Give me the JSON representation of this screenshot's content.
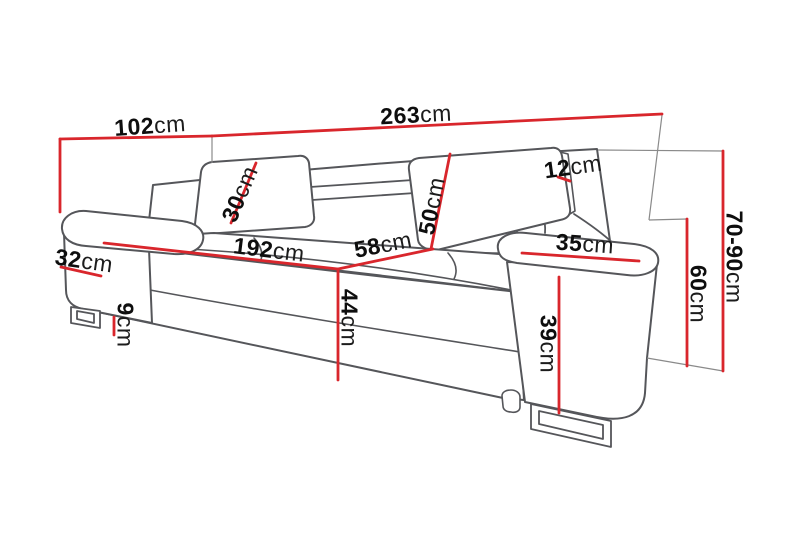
{
  "page": {
    "type": "product-dimension-diagram",
    "subject": "three-seat sofa with adjustable headrests",
    "background": "#ffffff"
  },
  "diagram": {
    "accent_color": "#d9262c",
    "line_color": "#55565a",
    "extension_line_color": "#8a8a8a",
    "unit": "cm",
    "dimensions": [
      {
        "id": "total-depth",
        "value": "102",
        "unit": "cm"
      },
      {
        "id": "total-width",
        "value": "263",
        "unit": "cm"
      },
      {
        "id": "headrest-height",
        "value": "30",
        "unit": "cm"
      },
      {
        "id": "backrest-height",
        "value": "50",
        "unit": "cm"
      },
      {
        "id": "headrest-thickness",
        "value": "12",
        "unit": "cm"
      },
      {
        "id": "seat-width",
        "value": "192",
        "unit": "cm"
      },
      {
        "id": "seat-depth",
        "value": "58",
        "unit": "cm"
      },
      {
        "id": "armrest-top-width",
        "value": "35",
        "unit": "cm"
      },
      {
        "id": "left-armrest-width",
        "value": "32",
        "unit": "cm"
      },
      {
        "id": "seat-height",
        "value": "44",
        "unit": "cm"
      },
      {
        "id": "leg-height",
        "value": "9",
        "unit": "cm"
      },
      {
        "id": "armrest-front-height",
        "value": "39",
        "unit": "cm"
      },
      {
        "id": "armrest-height",
        "value": "60",
        "unit": "cm"
      },
      {
        "id": "total-height",
        "value": "70-90",
        "unit": "cm"
      }
    ]
  }
}
